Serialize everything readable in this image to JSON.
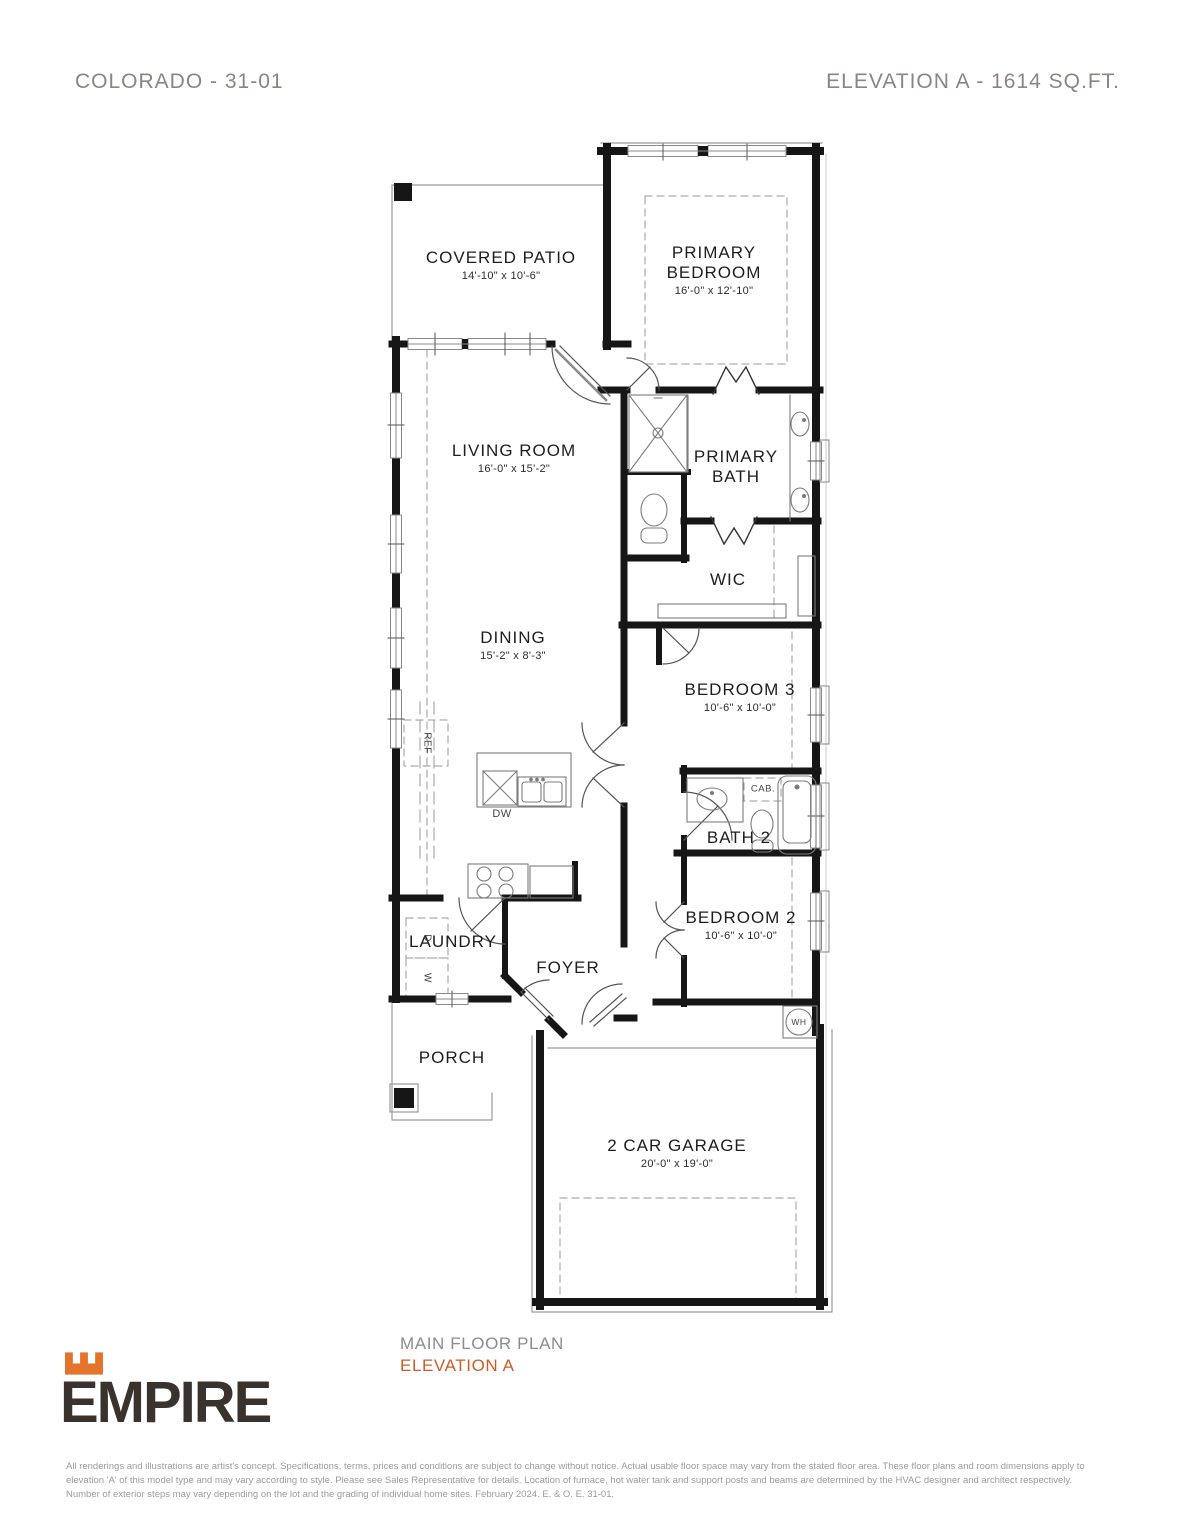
{
  "header": {
    "model": "COLORADO - 31-01",
    "elevation_info": "ELEVATION A - 1614 SQ.FT."
  },
  "plan": {
    "rooms": [
      {
        "id": "covered-patio",
        "name": "COVERED PATIO",
        "dims": "14'-10\" x 10'-6\""
      },
      {
        "id": "primary-bedroom",
        "name": "PRIMARY BEDROOM",
        "dims": "16'-0\" x 12'-10\""
      },
      {
        "id": "living-room",
        "name": "LIVING ROOM",
        "dims": "16'-0\" x 15'-2\""
      },
      {
        "id": "primary-bath",
        "name": "PRIMARY BATH",
        "dims": ""
      },
      {
        "id": "wic",
        "name": "WIC",
        "dims": ""
      },
      {
        "id": "dining",
        "name": "DINING",
        "dims": "15'-2\" x 8'-3\""
      },
      {
        "id": "bedroom-3",
        "name": "BEDROOM 3",
        "dims": "10'-6\" x 10'-0\""
      },
      {
        "id": "bath-2",
        "name": "BATH 2",
        "dims": ""
      },
      {
        "id": "bedroom-2",
        "name": "BEDROOM 2",
        "dims": "10'-6\" x 10'-0\""
      },
      {
        "id": "laundry",
        "name": "LAUNDRY",
        "dims": ""
      },
      {
        "id": "foyer",
        "name": "FOYER",
        "dims": ""
      },
      {
        "id": "porch",
        "name": "PORCH",
        "dims": ""
      },
      {
        "id": "garage",
        "name": "2 CAR GARAGE",
        "dims": "20'-0\" x 19'-0\""
      }
    ],
    "fixtures": {
      "ref": "REF",
      "dw": "DW",
      "cab": "CAB.",
      "wh": "WH",
      "washer": "W",
      "dryer": "D"
    }
  },
  "footer": {
    "plan_title": "MAIN FLOOR PLAN",
    "elevation": "ELEVATION A",
    "brand": "EMPIRE",
    "disclaimer_lines": [
      "All renderings and illustrations are artist's concept. Specifications, terms, prices and conditions are subject to change without notice. Actual usable floor space may vary from the stated floor area. These floor plans and room dimensions apply to",
      "elevation 'A' of this model type and may vary according to style. Please see Sales Representative for details. Location of furnace, hot water tank and support posts and beams are determined by the HVAC designer and architect respectively.",
      "Number of exterior steps may vary depending on the lot and the grading of individual home sites. February 2024. E. & O. E. 31-01."
    ]
  },
  "colors": {
    "accent_orange": "#cd5c28",
    "logo_brown": "#3a322c",
    "header_gray": "#8b8580",
    "wall_black": "#161616"
  }
}
